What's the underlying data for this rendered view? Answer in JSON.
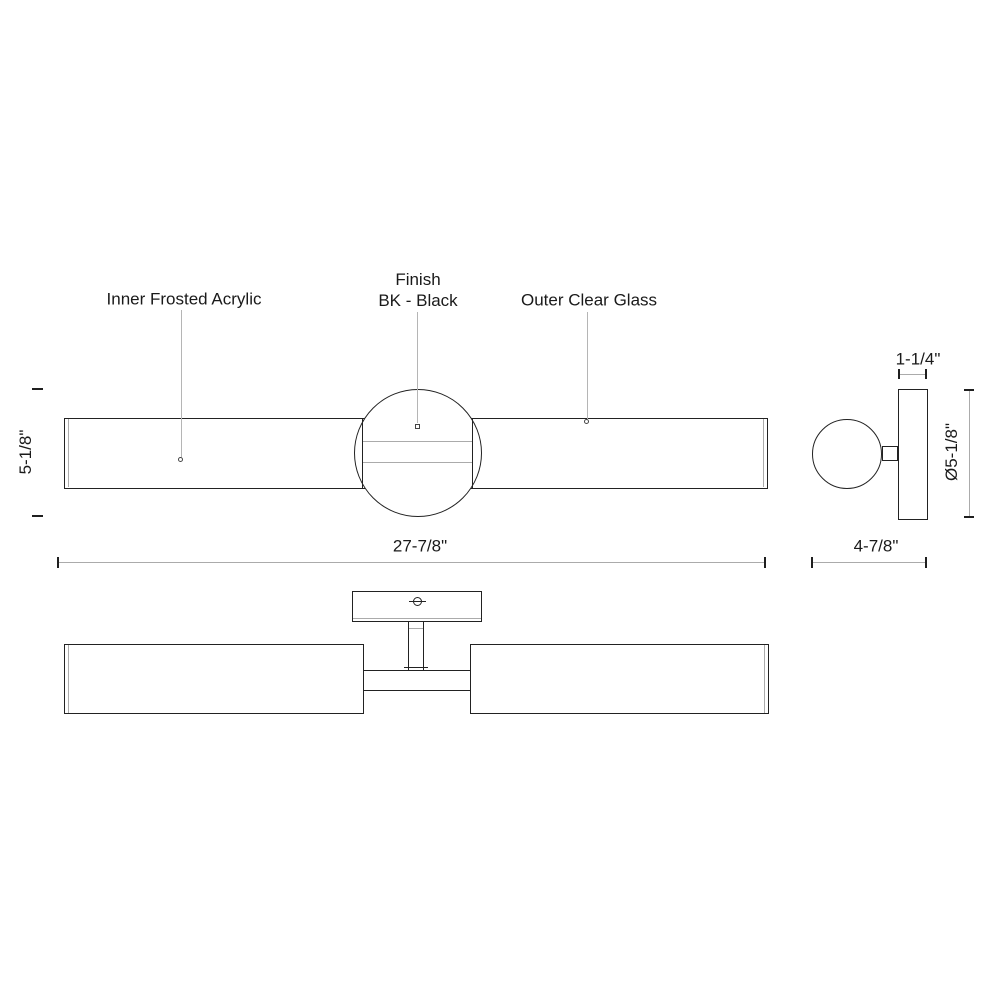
{
  "labels": {
    "inner_frosted_acrylic": "Inner Frosted Acrylic",
    "finish_line1": "Finish",
    "finish_line2": "BK - Black",
    "outer_clear_glass": "Outer Clear Glass"
  },
  "dimensions": {
    "overall_height": "5-1/8\"",
    "overall_width": "27-7/8\"",
    "canopy_depth": "1-1/4\"",
    "canopy_diameter": "Ø5-1/8\"",
    "overall_depth": "4-7/8\""
  },
  "icons": {
    "screw_head": "slotted-screw-head-icon"
  },
  "colors": {
    "background": "#ffffff",
    "line_dark": "#222222",
    "line_gray": "#ababab",
    "text": "#1a1a1a"
  }
}
